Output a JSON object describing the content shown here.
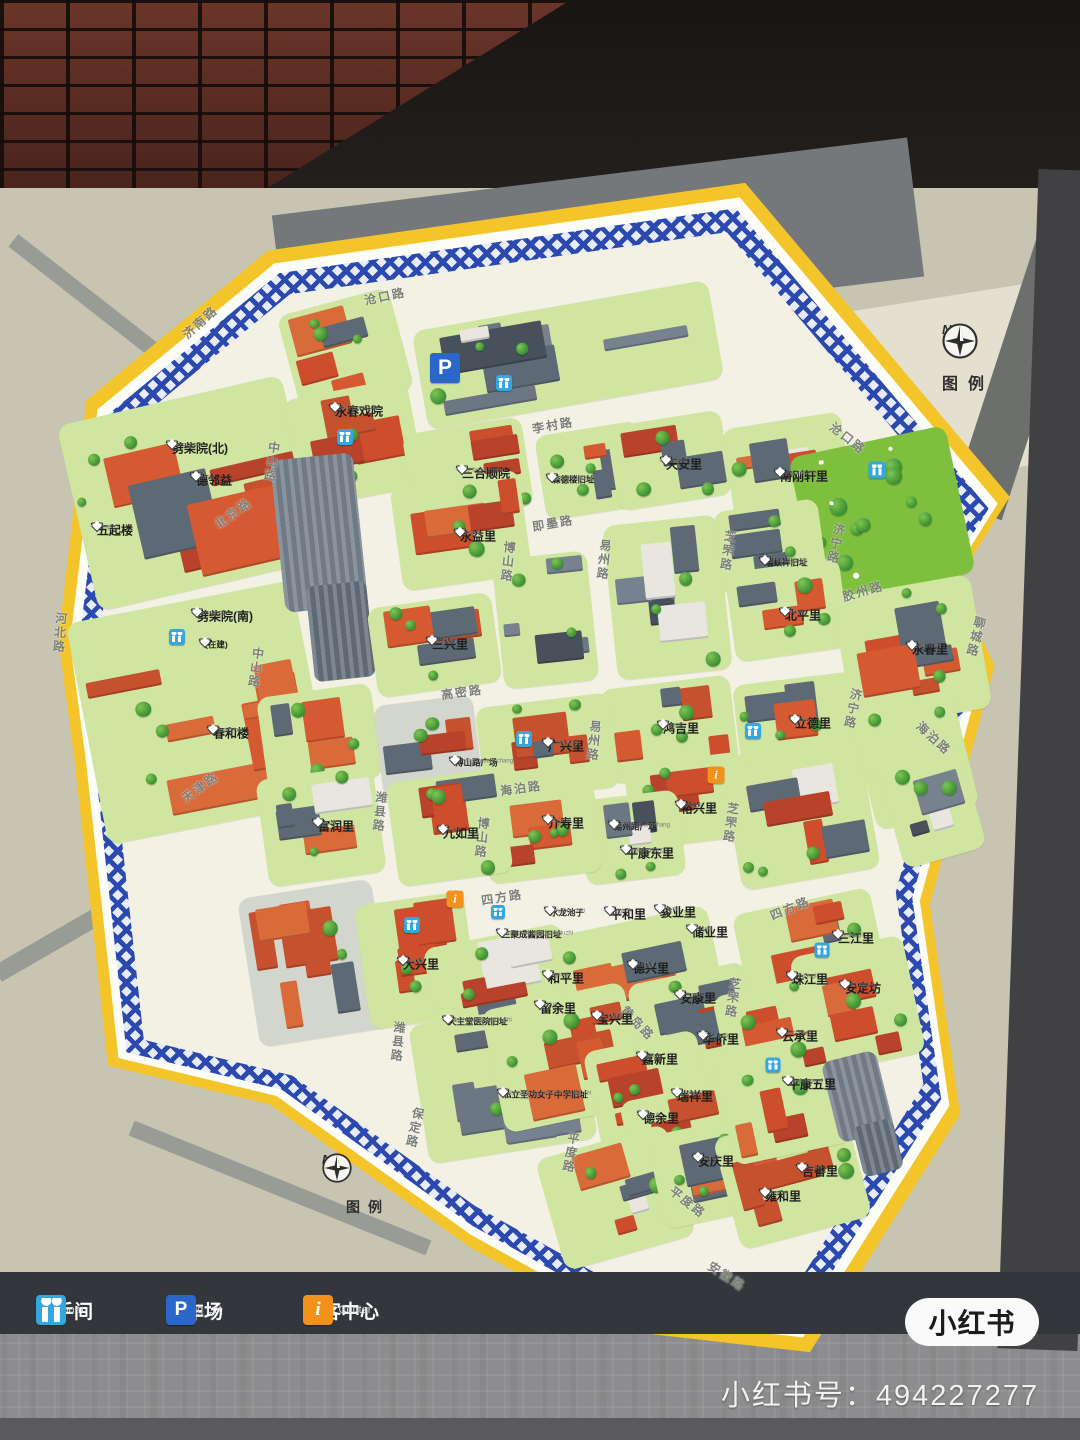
{
  "branding": {
    "logo": "小红书",
    "id_text": "小红书号：494227277"
  },
  "compass": {
    "north": "N",
    "legend_label": "图例"
  },
  "legend_bar": {
    "items": [
      {
        "type": "wc",
        "zh": "洗手间",
        "en": "Restroom"
      },
      {
        "type": "p",
        "zh": "停车场",
        "en": "Parking Lot"
      },
      {
        "type": "info",
        "zh": "游客中心",
        "en": "Tourist Center"
      }
    ]
  },
  "colors": {
    "border_yellow": "#f4c52a",
    "lattice_blue": "#2b49ae",
    "map_cream": "#f3f0e4",
    "block_green": "#cfe5a0",
    "roof_red": "#cc4e2c",
    "roof_orange": "#d96a3a",
    "slate": "#5d6a75",
    "wc_blue": "#36a6df",
    "parking_blue": "#2b66c9",
    "info_orange": "#f2921d"
  },
  "map": {
    "places": [
      {
        "zh": "劈柴院(北)",
        "py": "Pichaiyuan",
        "x": 172,
        "y": 442
      },
      {
        "zh": "德邻益",
        "py": "Delinyi",
        "x": 196,
        "y": 474
      },
      {
        "zh": "五起楼",
        "py": "Wuqilou",
        "x": 97,
        "y": 524
      },
      {
        "zh": "劈柴院(南)",
        "py": "Pichaiyuan",
        "x": 197,
        "y": 610
      },
      {
        "zh": "(在建)",
        "py": "",
        "x": 205,
        "y": 640,
        "small": true
      },
      {
        "zh": "春和楼",
        "py": "Chunhelou",
        "x": 213,
        "y": 727
      },
      {
        "zh": "永春戏院",
        "py": "Yongchunxiyuan",
        "x": 335,
        "y": 405
      },
      {
        "zh": "三合顺院",
        "py": "Sanheshunyuan",
        "x": 462,
        "y": 467
      },
      {
        "zh": "森德楼旧址",
        "py": "Sendeloujiuzhi",
        "x": 552,
        "y": 475,
        "small": true
      },
      {
        "zh": "天安里",
        "py": "Tiananli",
        "x": 666,
        "y": 458
      },
      {
        "zh": "南刚轩里",
        "py": "Nanganxuanli",
        "x": 780,
        "y": 470
      },
      {
        "zh": "瑞蚨祥旧址",
        "py": "Ruifuxiangjiuzhi",
        "x": 765,
        "y": 558,
        "small": true
      },
      {
        "zh": "北平里",
        "py": "Beipingli",
        "x": 785,
        "y": 609
      },
      {
        "zh": "永益里",
        "py": "Yongyili",
        "x": 460,
        "y": 530
      },
      {
        "zh": "三兴里",
        "py": "Sanxingli",
        "x": 432,
        "y": 638
      },
      {
        "zh": "永春里",
        "py": "Yongchunli",
        "x": 912,
        "y": 643
      },
      {
        "zh": "鸿吉里",
        "py": "Hongjili",
        "x": 663,
        "y": 722
      },
      {
        "zh": "立德里",
        "py": "Lideli",
        "x": 795,
        "y": 717
      },
      {
        "zh": "裕兴里",
        "py": "Yuxingli",
        "x": 681,
        "y": 802
      },
      {
        "zh": "易州路广场",
        "py": "Yizhouluguangchang",
        "x": 614,
        "y": 822,
        "small": true
      },
      {
        "zh": "平康东里",
        "py": "Pingkangdongli",
        "x": 626,
        "y": 847
      },
      {
        "zh": "博山路广场",
        "py": "Boshanluguangchang",
        "x": 455,
        "y": 758,
        "small": true
      },
      {
        "zh": "广兴里",
        "py": "Guangxingli",
        "x": 548,
        "y": 740
      },
      {
        "zh": "九如里",
        "py": "Jiuruli",
        "x": 443,
        "y": 827
      },
      {
        "zh": "介寿里",
        "py": "Jieshouli",
        "x": 548,
        "y": 817
      },
      {
        "zh": "富润里",
        "py": "Furunli",
        "x": 318,
        "y": 820
      },
      {
        "zh": "大兴里",
        "py": "Daxingli",
        "x": 403,
        "y": 958
      },
      {
        "zh": "水龙池子",
        "py": "Shuilongchizi",
        "x": 550,
        "y": 908,
        "small": true
      },
      {
        "zh": "平和里",
        "py": "Pingheli",
        "x": 610,
        "y": 908
      },
      {
        "zh": "骏业里",
        "py": "Junyeli",
        "x": 660,
        "y": 906
      },
      {
        "zh": "储业里",
        "py": "Chuyeli",
        "x": 692,
        "y": 926
      },
      {
        "zh": "德兴里",
        "py": "Dexingli",
        "x": 633,
        "y": 962
      },
      {
        "zh": "和平里",
        "py": "Hepingli",
        "x": 548,
        "y": 972
      },
      {
        "zh": "安康里",
        "py": "Ankangli",
        "x": 680,
        "y": 992
      },
      {
        "zh": "留余里",
        "py": "Liuyuli",
        "x": 540,
        "y": 1002
      },
      {
        "zh": "宝兴里",
        "py": "Baoxingli",
        "x": 597,
        "y": 1013
      },
      {
        "zh": "华侨里",
        "py": "Huaqiaoli",
        "x": 703,
        "y": 1033
      },
      {
        "zh": "嘉新里",
        "py": "Jiaxinli",
        "x": 642,
        "y": 1053
      },
      {
        "zh": "瑞祥里",
        "py": "Ruixiangli",
        "x": 677,
        "y": 1090
      },
      {
        "zh": "德余里",
        "py": "Deyuli",
        "x": 643,
        "y": 1112
      },
      {
        "zh": "三聚成酱园旧址",
        "py": "Sanjuchengjiangyuanjiuzhi",
        "x": 502,
        "y": 930,
        "small": true
      },
      {
        "zh": "天主堂医院旧址",
        "py": "Tianzhutangyiyuanjiuzhi",
        "x": 448,
        "y": 1017,
        "small": true
      },
      {
        "zh": "私立圣功女子中学旧址",
        "py": "Silishenggongnvzizhongxuejiuzhi",
        "x": 503,
        "y": 1090,
        "small": true
      },
      {
        "zh": "三江里",
        "py": "Sanjiangli",
        "x": 838,
        "y": 932
      },
      {
        "zh": "珠江里",
        "py": "Zhujiangli",
        "x": 792,
        "y": 973
      },
      {
        "zh": "安定坊",
        "py": "Andingfang",
        "x": 845,
        "y": 982
      },
      {
        "zh": "云承里",
        "py": "Yunchengli",
        "x": 782,
        "y": 1030
      },
      {
        "zh": "平康五里",
        "py": "Pingkangwuli",
        "x": 788,
        "y": 1078
      },
      {
        "zh": "安庆里",
        "py": "Anqingli",
        "x": 698,
        "y": 1155
      },
      {
        "zh": "吉善里",
        "py": "Jishanli",
        "x": 802,
        "y": 1165
      },
      {
        "zh": "雍和里",
        "py": "Yongheli",
        "x": 765,
        "y": 1190
      }
    ],
    "roads": [
      {
        "t": "济南路",
        "x": 200,
        "y": 322,
        "r": -42,
        "v": 0
      },
      {
        "t": "沧口路",
        "x": 385,
        "y": 296,
        "r": -12,
        "v": 0
      },
      {
        "t": "沧口路",
        "x": 848,
        "y": 438,
        "r": 38,
        "v": 0
      },
      {
        "t": "中山路",
        "x": 272,
        "y": 462,
        "r": 8,
        "v": 1
      },
      {
        "t": "中山路",
        "x": 256,
        "y": 668,
        "r": 8,
        "v": 1
      },
      {
        "t": "北京路",
        "x": 233,
        "y": 513,
        "r": -36,
        "v": 0
      },
      {
        "t": "天津路",
        "x": 200,
        "y": 787,
        "r": -36,
        "v": 0
      },
      {
        "t": "河北路",
        "x": 60,
        "y": 633,
        "r": 5,
        "v": 1
      },
      {
        "t": "李村路",
        "x": 553,
        "y": 425,
        "r": -10,
        "v": 0
      },
      {
        "t": "即墨路",
        "x": 553,
        "y": 523,
        "r": -10,
        "v": 0
      },
      {
        "t": "博山路",
        "x": 508,
        "y": 562,
        "r": 6,
        "v": 1
      },
      {
        "t": "博山路",
        "x": 482,
        "y": 838,
        "r": 6,
        "v": 1
      },
      {
        "t": "潍县路",
        "x": 380,
        "y": 812,
        "r": 6,
        "v": 1
      },
      {
        "t": "潍县路",
        "x": 398,
        "y": 1042,
        "r": 6,
        "v": 1
      },
      {
        "t": "易州路",
        "x": 604,
        "y": 560,
        "r": 6,
        "v": 1
      },
      {
        "t": "易州路",
        "x": 594,
        "y": 741,
        "r": 6,
        "v": 1
      },
      {
        "t": "芝罘路",
        "x": 728,
        "y": 551,
        "r": 8,
        "v": 1
      },
      {
        "t": "芝罘路",
        "x": 731,
        "y": 823,
        "r": 8,
        "v": 1
      },
      {
        "t": "芝罘路",
        "x": 733,
        "y": 998,
        "r": 8,
        "v": 1
      },
      {
        "t": "高密路",
        "x": 462,
        "y": 692,
        "r": -8,
        "v": 0
      },
      {
        "t": "海泊路",
        "x": 521,
        "y": 788,
        "r": -8,
        "v": 0
      },
      {
        "t": "海泊路",
        "x": 934,
        "y": 738,
        "r": 42,
        "v": 0
      },
      {
        "t": "四方路",
        "x": 502,
        "y": 897,
        "r": -9,
        "v": 0
      },
      {
        "t": "四方路",
        "x": 790,
        "y": 908,
        "r": -22,
        "v": 0
      },
      {
        "t": "黄岛路",
        "x": 638,
        "y": 1023,
        "r": 46,
        "v": 0
      },
      {
        "t": "济宁路",
        "x": 836,
        "y": 544,
        "r": 12,
        "v": 1
      },
      {
        "t": "济宁路",
        "x": 853,
        "y": 709,
        "r": 12,
        "v": 1
      },
      {
        "t": "胶州路",
        "x": 863,
        "y": 591,
        "r": -16,
        "v": 0
      },
      {
        "t": "聊城路",
        "x": 976,
        "y": 637,
        "r": 14,
        "v": 1
      },
      {
        "t": "平度路",
        "x": 571,
        "y": 1153,
        "r": 10,
        "v": 1
      },
      {
        "t": "平度路",
        "x": 688,
        "y": 1202,
        "r": 38,
        "v": 0
      },
      {
        "t": "保定路",
        "x": 415,
        "y": 1128,
        "r": 12,
        "v": 1
      },
      {
        "t": "安徽路",
        "x": 727,
        "y": 1276,
        "r": 33,
        "v": 0
      }
    ],
    "icons": [
      {
        "t": "p",
        "x": 445,
        "y": 368,
        "s": 30
      },
      {
        "t": "wc",
        "x": 504,
        "y": 383,
        "s": 16
      },
      {
        "t": "wc",
        "x": 345,
        "y": 437,
        "s": 16
      },
      {
        "t": "wc",
        "x": 877,
        "y": 470,
        "s": 17
      },
      {
        "t": "wc",
        "x": 753,
        "y": 731,
        "s": 16
      },
      {
        "t": "wc",
        "x": 524,
        "y": 739,
        "s": 16
      },
      {
        "t": "wc",
        "x": 412,
        "y": 925,
        "s": 16
      },
      {
        "t": "wc",
        "x": 177,
        "y": 637,
        "s": 16
      },
      {
        "t": "wc",
        "x": 822,
        "y": 950,
        "s": 15
      },
      {
        "t": "wc",
        "x": 773,
        "y": 1065,
        "s": 15
      },
      {
        "t": "wc",
        "x": 498,
        "y": 912,
        "s": 14
      },
      {
        "t": "info",
        "x": 716,
        "y": 775,
        "s": 17
      },
      {
        "t": "info",
        "x": 455,
        "y": 899,
        "s": 17
      }
    ],
    "blocks": [
      [
        75,
        398,
        230,
        190,
        -13,
        "red"
      ],
      [
        85,
        600,
        230,
        225,
        -11,
        "red"
      ],
      [
        288,
        300,
        115,
        105,
        -15,
        "red"
      ],
      [
        418,
        305,
        300,
        100,
        -10,
        "slate"
      ],
      [
        292,
        388,
        125,
        110,
        -11,
        "red"
      ],
      [
        272,
        445,
        118,
        240,
        -6,
        "tower"
      ],
      [
        408,
        425,
        120,
        90,
        -9,
        "red"
      ],
      [
        540,
        428,
        105,
        85,
        -9,
        "red"
      ],
      [
        612,
        418,
        115,
        85,
        -9,
        "red"
      ],
      [
        728,
        420,
        120,
        95,
        -9,
        "mixed"
      ],
      [
        802,
        440,
        160,
        150,
        -12,
        "park"
      ],
      [
        396,
        478,
        130,
        105,
        -8,
        "red"
      ],
      [
        498,
        555,
        95,
        130,
        -6,
        "slate"
      ],
      [
        610,
        520,
        115,
        155,
        -6,
        "slate"
      ],
      [
        718,
        505,
        105,
        85,
        -8,
        "red"
      ],
      [
        730,
        565,
        115,
        90,
        -8,
        "red"
      ],
      [
        842,
        585,
        140,
        135,
        -10,
        "red"
      ],
      [
        372,
        600,
        125,
        90,
        -8,
        "red"
      ],
      [
        262,
        690,
        115,
        95,
        -8,
        "red"
      ],
      [
        605,
        682,
        130,
        95,
        -7,
        "red"
      ],
      [
        737,
        678,
        125,
        92,
        -7,
        "red"
      ],
      [
        862,
        700,
        105,
        120,
        -14,
        "mixed"
      ],
      [
        480,
        700,
        135,
        95,
        -7,
        "red"
      ],
      [
        378,
        700,
        100,
        92,
        -7,
        "plaza"
      ],
      [
        628,
        758,
        120,
        85,
        -7,
        "red"
      ],
      [
        582,
        795,
        100,
        85,
        -7,
        "slate"
      ],
      [
        484,
        790,
        115,
        88,
        -7,
        "red"
      ],
      [
        732,
        765,
        140,
        115,
        -10,
        "mixed"
      ],
      [
        888,
        745,
        85,
        115,
        -16,
        "slate"
      ],
      [
        262,
        772,
        118,
        108,
        -8,
        "mixed"
      ],
      [
        392,
        775,
        115,
        105,
        -8,
        "mixed"
      ],
      [
        248,
        888,
        135,
        150,
        -9,
        "plaza"
      ],
      [
        362,
        898,
        110,
        125,
        -8,
        "red"
      ],
      [
        432,
        935,
        140,
        115,
        -11,
        "mixed"
      ],
      [
        418,
        1012,
        170,
        140,
        -9,
        "slate"
      ],
      [
        560,
        920,
        160,
        120,
        -12,
        "red"
      ],
      [
        638,
        972,
        120,
        125,
        -12,
        "red"
      ],
      [
        492,
        995,
        145,
        125,
        -12,
        "red"
      ],
      [
        592,
        1040,
        115,
        105,
        -12,
        "red"
      ],
      [
        628,
        1090,
        115,
        100,
        -12,
        "red"
      ],
      [
        548,
        1140,
        135,
        115,
        -16,
        "mixed"
      ],
      [
        655,
        1125,
        105,
        95,
        -12,
        "red"
      ],
      [
        725,
        1120,
        135,
        115,
        -15,
        "red"
      ],
      [
        742,
        900,
        140,
        115,
        -12,
        "mixed"
      ],
      [
        800,
        945,
        115,
        120,
        -12,
        "red"
      ],
      [
        722,
        985,
        110,
        110,
        -12,
        "red"
      ],
      [
        722,
        1040,
        120,
        115,
        -12,
        "mixed"
      ],
      [
        828,
        1048,
        80,
        130,
        -14,
        "tower"
      ]
    ]
  }
}
